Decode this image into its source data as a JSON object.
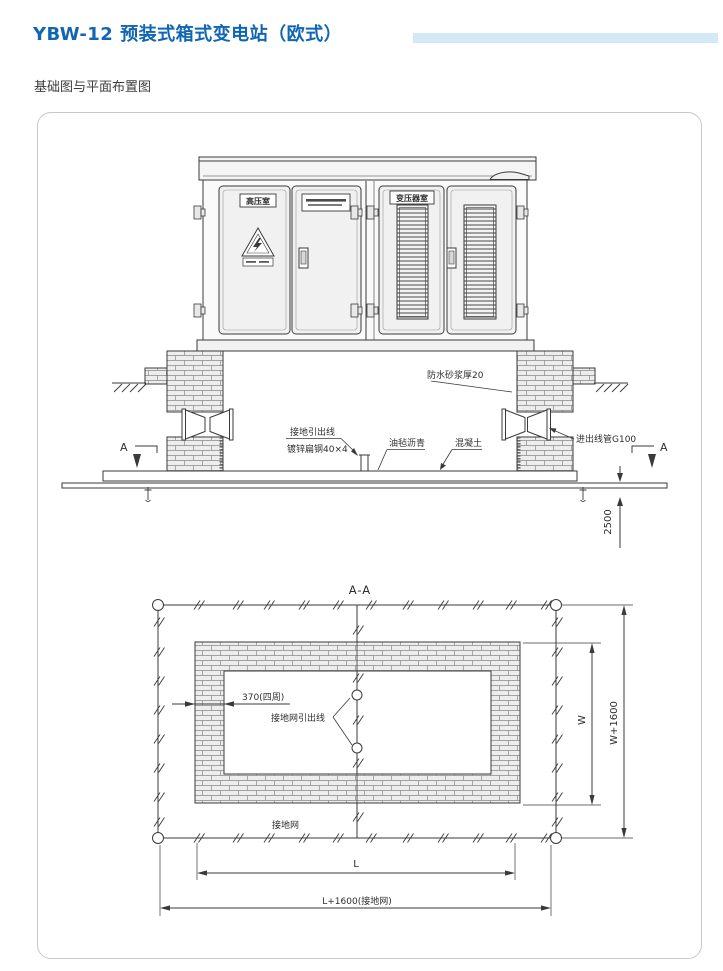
{
  "header": {
    "title": "YBW-12 预装式箱式变电站（欧式）",
    "subtitle": "基础图与平面布置图"
  },
  "elevation": {
    "room_hv_label": "高压室",
    "room_transformer_label": "变压器室",
    "ann_waterproof_mortar": "防水砂浆厚20",
    "ann_ground_lead": "接地引出线",
    "ann_flat_steel": "镀锌扁钢40×4",
    "ann_asphalt_felt": "油毡沥青",
    "ann_concrete": "混凝土",
    "ann_conduit": "进出线管G100",
    "dim_depth": "2500",
    "section_letter": "A"
  },
  "plan": {
    "title": "A-A",
    "ann_wall_thickness": "370(四周)",
    "ann_grid_lead": "接地网引出线",
    "ann_grid": "接地网",
    "dim_w": "W",
    "dim_w_outer": "W+1600",
    "dim_l": "L",
    "dim_l_outer": "L+1600(接地网)"
  },
  "colors": {
    "title_blue": "#1066b5",
    "strip_blue": "#d3e9f8",
    "line_dark": "#3a3a3a"
  }
}
